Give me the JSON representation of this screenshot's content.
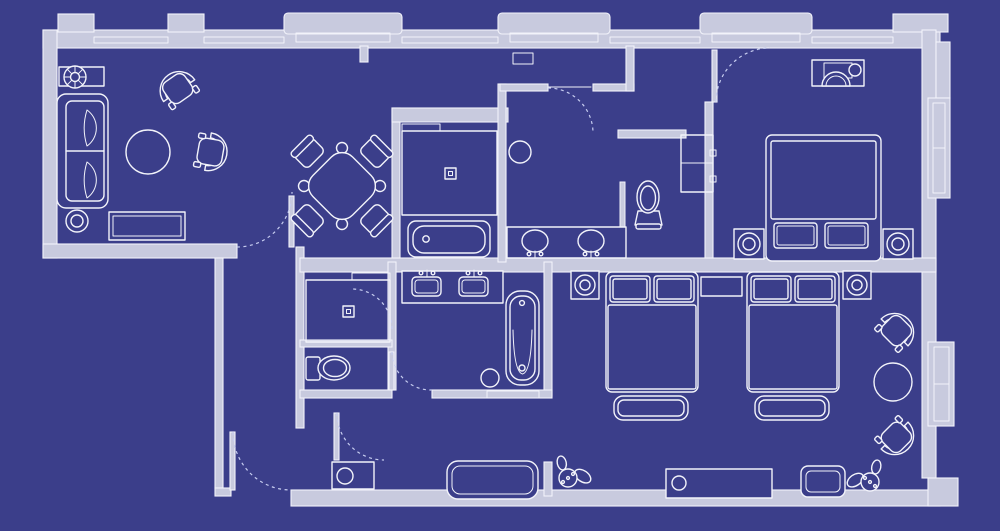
{
  "meta": {
    "title": "Hotel suite floor plan — blueprint style drawing",
    "type": "architectural-floor-plan",
    "view": "top-down",
    "text_labels_visible": "none"
  },
  "colors": {
    "background": "#3b3e8a",
    "line": "#f2f3fa",
    "line_soft": "#c7cdf0",
    "wall_fill": "#c8cade"
  },
  "drawing_conventions": {
    "walls": "double white outline with light grey fill",
    "door_swings": "dashed quarter-circle arcs",
    "windows": "thin double lines set into exterior wall band with bay bump-outs"
  },
  "rooms": [
    {
      "name": "living-room",
      "position": "top-left wing",
      "furniture": [
        "sofa",
        "plant-on-side-table",
        "round-side-table",
        "media-console",
        "armchair",
        "armchair",
        "round-coffee-table"
      ]
    },
    {
      "name": "dining-area",
      "position": "top-center-left",
      "furniture": [
        "square-dining-table-rotated-45",
        "dining-chair x4"
      ]
    },
    {
      "name": "shower-room-upper",
      "position": "top-center",
      "furniture": [
        "walk-in-shower-with-drain",
        "built-in-bathtub",
        "wall-shelf"
      ]
    },
    {
      "name": "bathroom-upper",
      "position": "top-center-right",
      "furniture": [
        "round-stool",
        "double-sink-vanity",
        "toilet",
        "linen-closet-with-shelf"
      ]
    },
    {
      "name": "bedroom-1",
      "position": "top-right",
      "furniture": [
        "desk-with-lamp",
        "desk-chair",
        "king-bed-two-pillows",
        "nightstand-with-lamp x2"
      ]
    },
    {
      "name": "bathroom-lower",
      "position": "center-left",
      "furniture": [
        "walk-in-shower-with-drain",
        "toilet",
        "double-sink-vanity-with-faucets",
        "freestanding-bathtub",
        "round-stool",
        "bath-mat"
      ]
    },
    {
      "name": "bedroom-2",
      "position": "bottom-right",
      "furniture": [
        "table-lamp-square x2",
        "double-bed-with-bench x2",
        "shared-nightstand",
        "armchair x2",
        "round-table",
        "long-dresser",
        "square-side-table",
        "potted-plant x2"
      ]
    },
    {
      "name": "entry-hall",
      "position": "bottom-left",
      "furniture": [
        "double-entry-door",
        "utility-cabinet-with-basin",
        "long-bench",
        "potted-plant"
      ]
    },
    {
      "name": "corridor",
      "position": "left connecting strip",
      "furniture": []
    }
  ],
  "doors": {
    "count": 7,
    "style": "dashed swing arcs with open leaf shown"
  },
  "windows": {
    "top_wall_bays": 3,
    "top_wall_glazing_segments": 5,
    "right_wall_bays": 2
  }
}
